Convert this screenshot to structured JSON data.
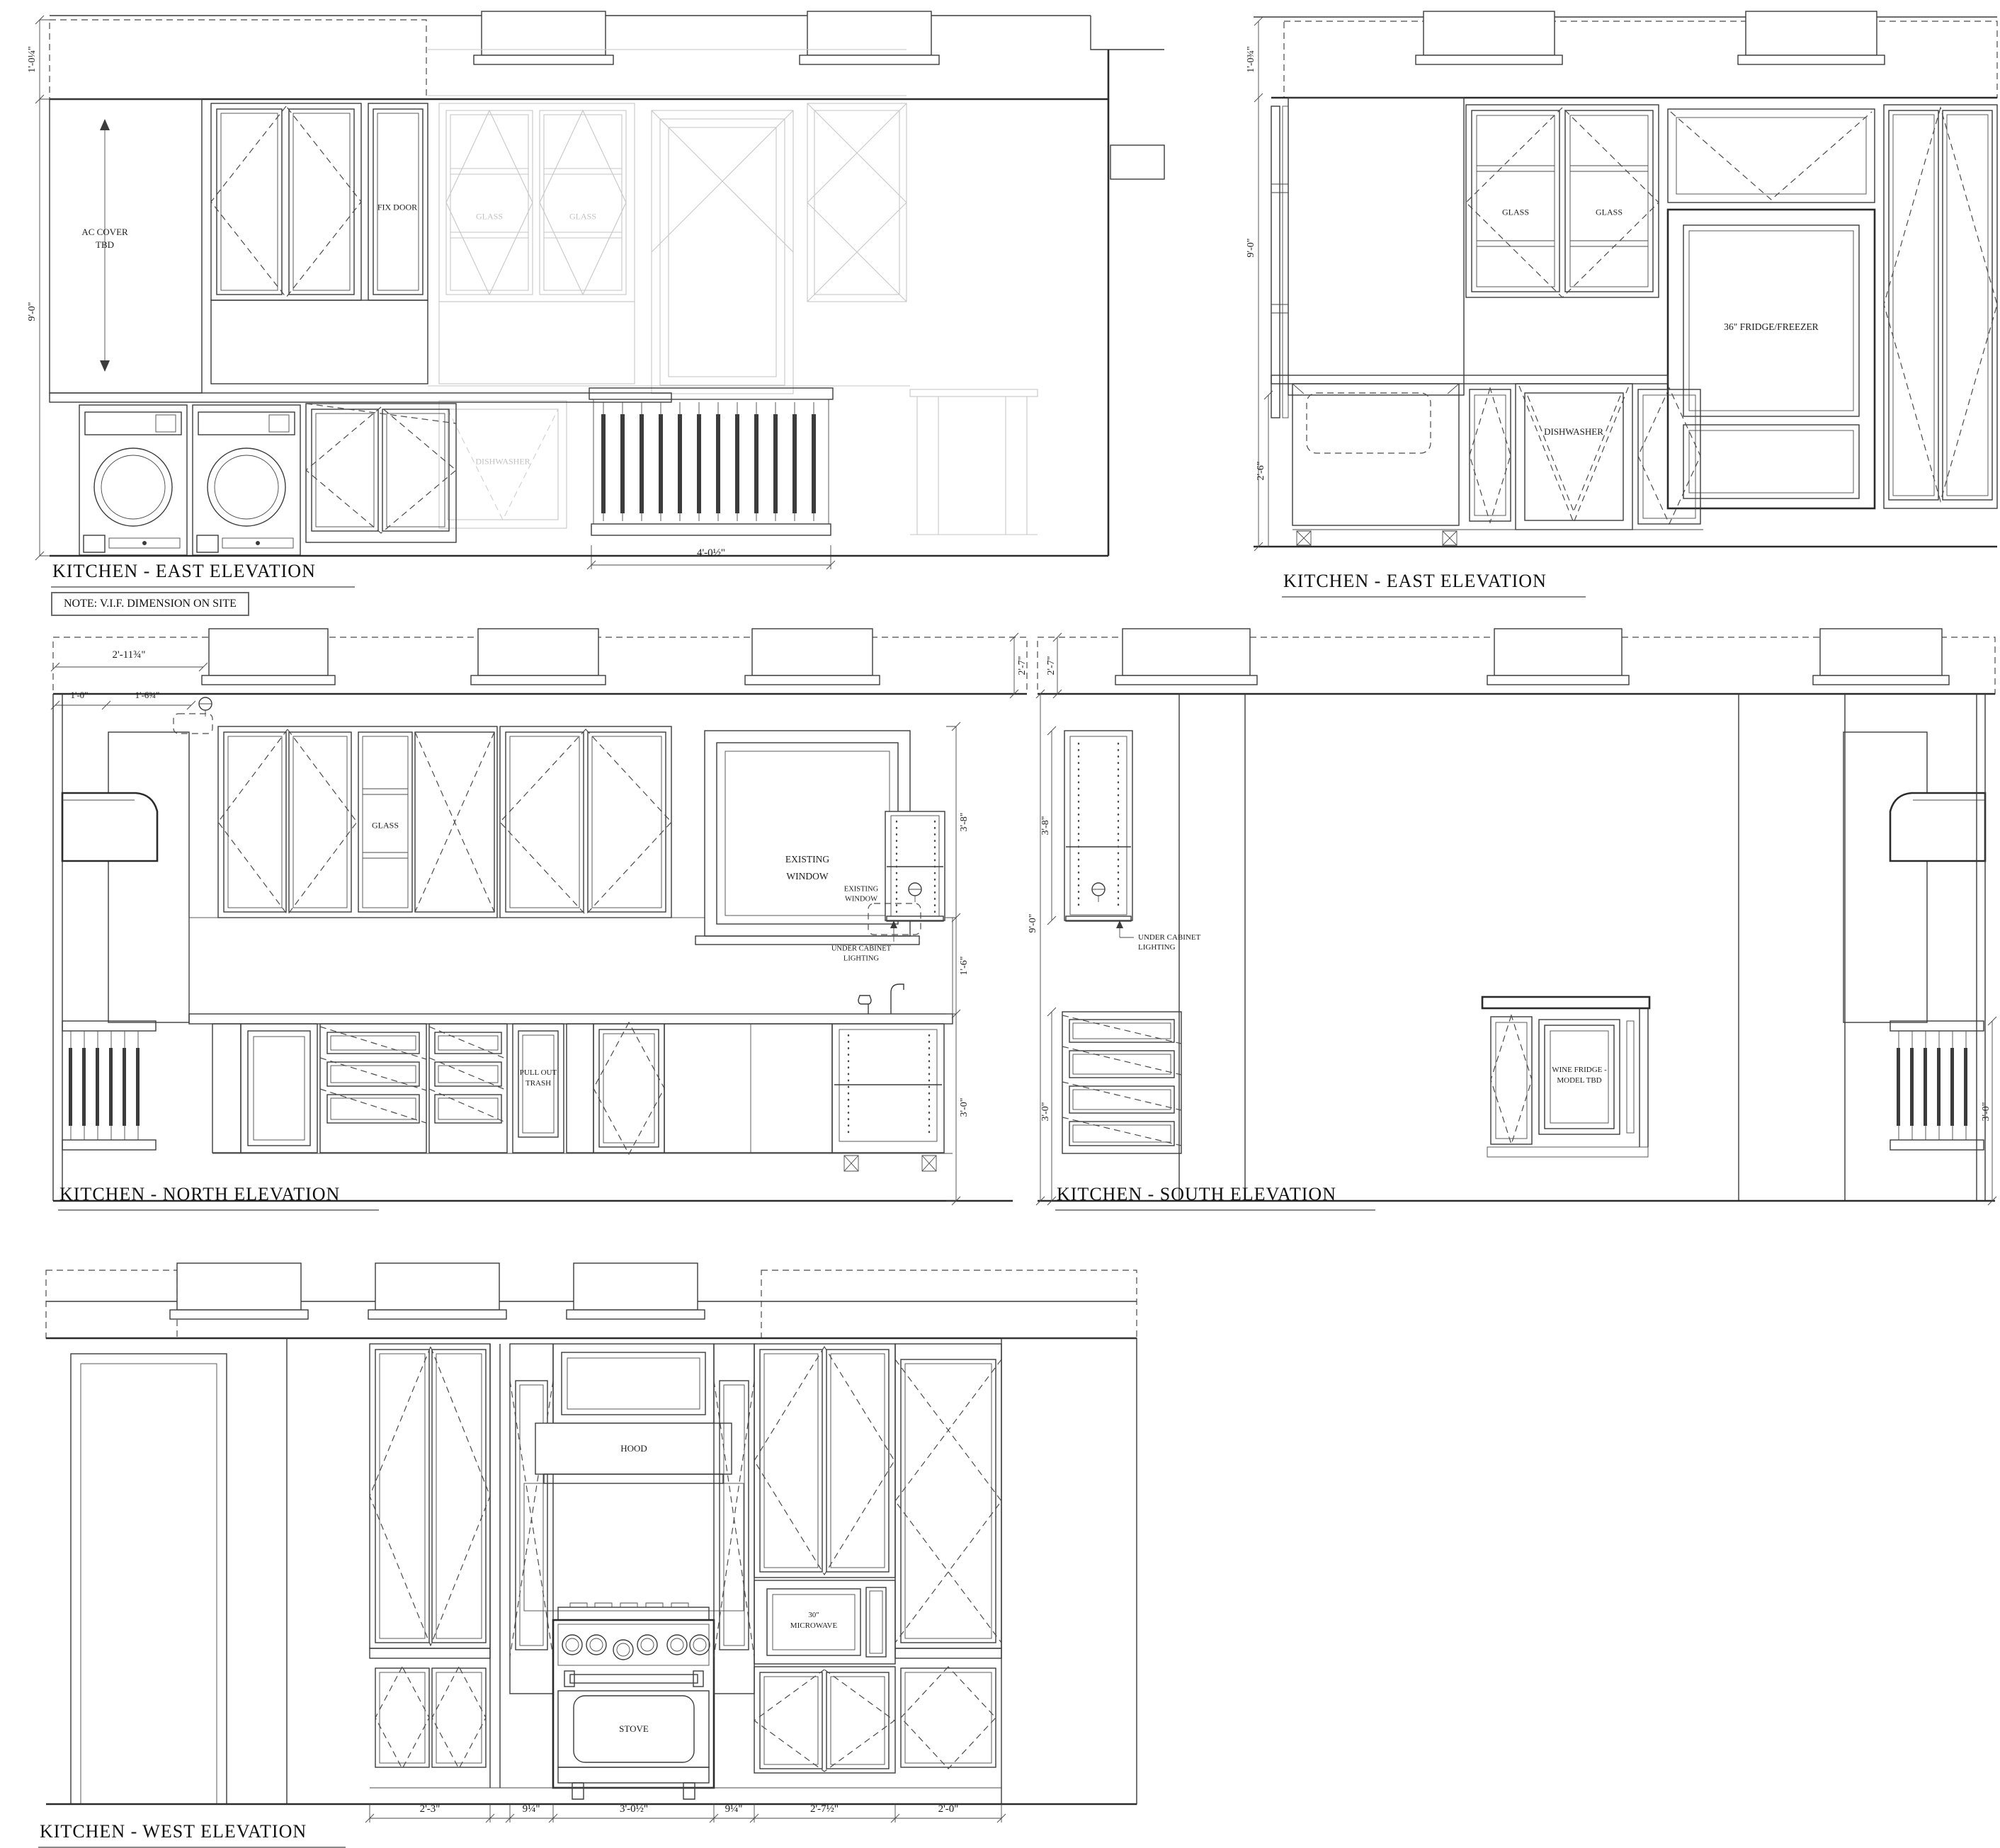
{
  "east1": {
    "title": "KITCHEN - EAST ELEVATION",
    "note": "NOTE: V.I.F. DIMENSION ON SITE",
    "ac_cover_line1": "AC COVER",
    "ac_cover_line2": "TBD",
    "fix_door": "FIX DOOR",
    "glass_left": "GLASS",
    "glass_right": "GLASS",
    "dishwasher": "DISHWASHER",
    "radiator_width": "4'-0½\"",
    "dim_soffit": "1'-0¼\"",
    "dim_height": "9'-0\""
  },
  "east2": {
    "title": "KITCHEN - EAST ELEVATION",
    "glass_left": "GLASS",
    "glass_right": "GLASS",
    "fridge": "36\" FRIDGE/FREEZER",
    "dishwasher": "DISHWASHER",
    "dim_soffit": "1'-0¾\"",
    "dim_height": "9'-0\"",
    "dim_base": "2'-6\""
  },
  "north": {
    "title": "KITCHEN - NORTH ELEVATION",
    "dim_soffit_total": "2'-11¾\"",
    "dim_soffit_a": "1'-0\"",
    "dim_soffit_b": "1'-6¾\"",
    "dim_right_soffit": "2'-7\"",
    "dim_uppers": "3'-8\"",
    "dim_backsplash": "1'-6\"",
    "dim_base": "3'-0\"",
    "glass": "GLASS",
    "existing_window_line1": "EXISTING",
    "existing_window_line2": "WINDOW",
    "existing_window_small_line1": "EXISTING",
    "existing_window_small_line2": "WINDOW",
    "under_cabinet_line1": "UNDER CABINET",
    "under_cabinet_line2": "LIGHTING",
    "pull_out_line1": "PULL OUT",
    "pull_out_line2": "TRASH"
  },
  "south": {
    "title": "KITCHEN - SOUTH ELEVATION",
    "dim_left_soffit": "2'-7\"",
    "dim_uppers": "3'-8\"",
    "dim_height": "9'-0\"",
    "dim_base": "3'-0\"",
    "dim_right_base": "3'-0\"",
    "under_cabinet_line1": "UNDER CABINET",
    "under_cabinet_line2": "LIGHTING",
    "wine_line1": "WINE FRIDGE -",
    "wine_line2": "MODEL TBD"
  },
  "west": {
    "title": "KITCHEN - WEST ELEVATION",
    "hood": "HOOD",
    "microwave_line1": "30\"",
    "microwave_line2": "MICROWAVE",
    "stove": "STOVE",
    "dims": [
      "2'-3\"",
      "9¼\"",
      "3'-0½\"",
      "9¼\"",
      "2'-7½\"",
      "2'-0\""
    ]
  }
}
